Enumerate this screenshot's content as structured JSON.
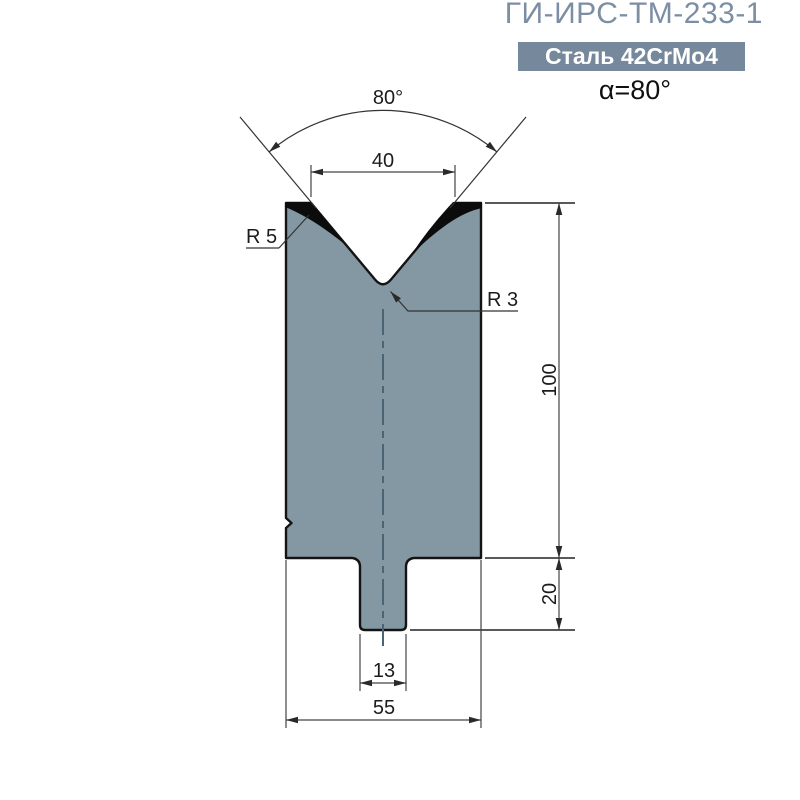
{
  "header": {
    "title": "ГИ-ИРС-ТМ-233-1",
    "material_badge": "Сталь 42CrMo4",
    "angle_label": "α=80°"
  },
  "drawing": {
    "type": "press-brake-die-cross-section",
    "dimensions": {
      "vee_angle": "80°",
      "vee_opening_width": "40",
      "shoulder_radius": "R 5",
      "vee_bottom_radius": "R 3",
      "body_height": "100",
      "tang_height": "20",
      "tang_width": "13",
      "body_width": "55"
    },
    "colors": {
      "body_fill": "#8498a4",
      "outline": "#141414",
      "centerline": "#4a6473",
      "dimension_line": "#4a4a4a",
      "title_text": "#7b8ea4",
      "badge_bg": "#76889b",
      "badge_text": "#ffffff"
    }
  }
}
